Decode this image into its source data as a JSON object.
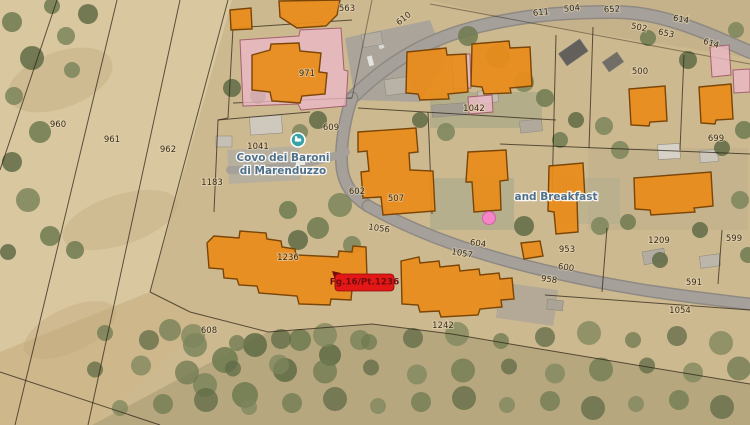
{
  "map": {
    "marker": {
      "text": "Fg.16/Pt.1236",
      "x": 335,
      "y": 274,
      "w": 59,
      "h": 17,
      "bg": "#e41717",
      "border": "#8a0d0d",
      "text_color": "#6f0d10"
    },
    "pois": [
      {
        "id": "lodging-covo",
        "lines": [
          "Covo dei Baroni",
          "di Marenduzzo"
        ],
        "x": 283,
        "y": 158,
        "line_gap": 13,
        "icon": {
          "name": "lodging-poi-icon",
          "x": 298,
          "y": 140,
          "color": "#35a2a6"
        }
      },
      {
        "id": "bed-and-breakfast",
        "lines": [
          "and Breakfast"
        ],
        "x": 556,
        "y": 197,
        "line_gap": 13
      }
    ],
    "pool": {
      "cx": 489,
      "cy": 218,
      "r": 6.5,
      "color": "#ff80d2",
      "border": "#d84fb0"
    },
    "parcel_labels": [
      {
        "t": "960",
        "x": 58,
        "y": 125
      },
      {
        "t": "961",
        "x": 112,
        "y": 140
      },
      {
        "t": "962",
        "x": 168,
        "y": 150
      },
      {
        "t": "1183",
        "x": 212,
        "y": 183
      },
      {
        "t": "563",
        "x": 347,
        "y": 9
      },
      {
        "t": "610",
        "x": 404,
        "y": 19,
        "r": -38
      },
      {
        "t": "971",
        "x": 307,
        "y": 74
      },
      {
        "t": "609",
        "x": 331,
        "y": 128
      },
      {
        "t": "1041",
        "x": 258,
        "y": 147
      },
      {
        "t": "602",
        "x": 357,
        "y": 192
      },
      {
        "t": "507",
        "x": 396,
        "y": 199
      },
      {
        "t": "1042",
        "x": 474,
        "y": 109
      },
      {
        "t": "611",
        "x": 541,
        "y": 13,
        "r": -6
      },
      {
        "t": "504",
        "x": 572,
        "y": 9,
        "r": -6
      },
      {
        "t": "652",
        "x": 612,
        "y": 10,
        "r": -4
      },
      {
        "t": "614",
        "x": 681,
        "y": 20,
        "r": 10
      },
      {
        "t": "502",
        "x": 639,
        "y": 28,
        "r": 12
      },
      {
        "t": "653",
        "x": 666,
        "y": 34,
        "r": 12
      },
      {
        "t": "614",
        "x": 711,
        "y": 44,
        "r": 16
      },
      {
        "t": "500",
        "x": 640,
        "y": 72
      },
      {
        "t": "699",
        "x": 716,
        "y": 139
      },
      {
        "t": "1236",
        "x": 288,
        "y": 258
      },
      {
        "t": "1056",
        "x": 379,
        "y": 229,
        "r": 8
      },
      {
        "t": "604",
        "x": 478,
        "y": 244,
        "r": 8
      },
      {
        "t": "1057",
        "x": 462,
        "y": 254,
        "r": 10
      },
      {
        "t": "1242",
        "x": 443,
        "y": 326
      },
      {
        "t": "608",
        "x": 209,
        "y": 331
      },
      {
        "t": "953",
        "x": 567,
        "y": 250
      },
      {
        "t": "600",
        "x": 566,
        "y": 268,
        "r": 8
      },
      {
        "t": "958",
        "x": 549,
        "y": 280,
        "r": 8
      },
      {
        "t": "591",
        "x": 694,
        "y": 283
      },
      {
        "t": "1054",
        "x": 680,
        "y": 311
      },
      {
        "t": "1209",
        "x": 659,
        "y": 241
      },
      {
        "t": "599",
        "x": 734,
        "y": 239
      }
    ],
    "buildings": [
      {
        "id": "building-north-hut",
        "points": "230,10 251,8 252,29 231,30"
      },
      {
        "id": "building-563",
        "points": "279,1 340,0 337,15 326,26 297,28 280,17"
      },
      {
        "id": "building-971",
        "points": "252,55 270,50 271,44 299,43 300,51 321,53 319,72 327,73 325,94 302,96 300,103 272,101 270,92 252,90"
      },
      {
        "id": "building-1042-west",
        "points": "407,52 446,48 447,55 466,54 468,92 448,94 449,99 420,100 418,94 406,93"
      },
      {
        "id": "building-1042-east",
        "points": "472,44 509,41 510,48 530,47 532,86 510,88 511,93 484,94 482,87 471,86"
      },
      {
        "id": "building-ne-1",
        "points": "629,89 665,86 667,121 650,122 649,126 631,125"
      },
      {
        "id": "building-ne-2",
        "points": "699,87 731,84 733,119 716,120 715,124 701,123"
      },
      {
        "id": "building-507",
        "points": "358,132 416,128 418,152 409,153 410,170 433,171 435,211 383,215 381,197 363,198 361,172 369,171 367,151 358,152"
      },
      {
        "id": "building-bnb-west",
        "points": "468,152 506,150 508,180 500,181 501,210 474,212 472,182 466,182"
      },
      {
        "id": "building-bnb-mid",
        "points": "549,166 583,163 585,199 577,200 578,232 556,234 554,212 548,211"
      },
      {
        "id": "building-bnb-east",
        "points": "634,178 711,172 713,206 694,208 695,212 651,215 650,210 635,209"
      },
      {
        "id": "building-1236",
        "points": "207,243 214,236 239,238 240,231 266,233 267,239 281,241 282,247 295,249 296,255 338,257 339,251 352,252 353,246 366,247 367,277 353,278 351,300 331,299 330,305 299,304 297,296 259,293 257,286 239,285 237,279 224,278 223,269 209,268"
      },
      {
        "id": "building-1057",
        "points": "401,261 419,257 420,263 439,261 440,267 459,265 460,271 479,269 480,275 499,273 500,279 512,278 514,299 501,300 502,307 480,309 478,315 441,317 439,311 420,312 418,305 402,304"
      },
      {
        "id": "building-court",
        "points": "521,243 540,241 543,256 524,259"
      }
    ],
    "pink_footprints": [
      {
        "points": "240,40 299,36 300,30 341,28 344,70 348,71 346,106 301,110 298,104 243,106"
      },
      {
        "points": "452,55 470,54 471,88 453,89"
      },
      {
        "points": "468,97 492,95 493,112 469,114"
      },
      {
        "points": "710,47 729,45 731,75 712,77"
      },
      {
        "points": "733,70 750,69 750,92 734,93"
      }
    ],
    "colors": {
      "building_fill": "#e88c1c",
      "building_stroke": "#7a4506",
      "footprint_pink": "#ecb9c6",
      "label": "#3a2d1b",
      "poi_text": "#4f7089"
    }
  }
}
